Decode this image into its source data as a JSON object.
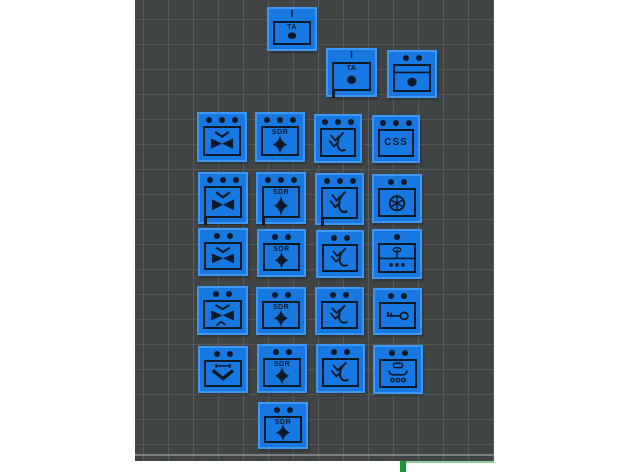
{
  "app": {
    "name": "3d-slicer-viewport",
    "description": "Build plate with 24 flat unit-marker tiles arranged for printing"
  },
  "colors": {
    "page_bg": "#ffffff",
    "plate_bg": "#404445",
    "grid_line": "#565b5c",
    "tile_fill": "#1778e2",
    "tile_outline": "#3e97f3",
    "glyph": "#0c1a28",
    "accent_green_bar": "#1a9638",
    "accent_green_line": "#8ccf98"
  },
  "viewport": {
    "x": 135,
    "y": 0,
    "width": 359,
    "height": 461,
    "grid_size_px": 25
  },
  "accents": {
    "green_bar": {
      "x": 400,
      "y": 461,
      "w": 6,
      "h": 11
    },
    "green_line": {
      "x": 406,
      "y": 461,
      "w": 88,
      "h": 2
    }
  },
  "symbols": {
    "filled-circle": "frame with TA text and solid circle",
    "band-circle": "frame with top band line and solid circle",
    "chevron-bowtie": "down chevron over solid bowtie",
    "chevron-bowtie-caret": "down chevron, solid bowtie, small caret below",
    "bar-chevron": "capped horizontal bar over bold down chevron",
    "four-point-diamond": "SDR text over solid four-point diamond",
    "double-chevron-curve": "two down-left chevrons crossed by curved stroke",
    "none": "text only frame",
    "spoked-wheel": "circle with six spokes",
    "post-ellipse-dots": "split frame, post with ellipse above, three dots below",
    "key": "horizontal key with round bow",
    "yoke-pill-dots": "pill outline, flared yoke bar, three small rings"
  },
  "tiles": [
    {
      "id": "a1",
      "symbol": "filled-circle",
      "label": "TA",
      "echelon_text": "I",
      "flag": false,
      "x": 267,
      "y": 7,
      "w": 50,
      "h": 44
    },
    {
      "id": "b1",
      "symbol": "filled-circle",
      "label": "TA",
      "echelon_text": "I",
      "flag": true,
      "x": 326,
      "y": 48,
      "w": 51,
      "h": 49
    },
    {
      "id": "b2",
      "symbol": "band-circle",
      "echelon_dots": 2,
      "x": 387,
      "y": 50,
      "w": 50,
      "h": 48
    },
    {
      "id": "c1",
      "symbol": "chevron-bowtie",
      "echelon_dots": 3,
      "x": 197,
      "y": 112,
      "w": 50,
      "h": 50
    },
    {
      "id": "c2",
      "symbol": "four-point-diamond",
      "label": "SDR",
      "echelon_dots": 3,
      "x": 255,
      "y": 112,
      "w": 50,
      "h": 50
    },
    {
      "id": "c3",
      "symbol": "double-chevron-curve",
      "echelon_dots": 3,
      "x": 314,
      "y": 114,
      "w": 48,
      "h": 49
    },
    {
      "id": "c4",
      "symbol": "none",
      "label": "CSS",
      "echelon_dots": 3,
      "x": 372,
      "y": 115,
      "w": 48,
      "h": 48
    },
    {
      "id": "d1",
      "symbol": "chevron-bowtie",
      "echelon_dots": 3,
      "flag": true,
      "x": 198,
      "y": 172,
      "w": 50,
      "h": 52
    },
    {
      "id": "d2",
      "symbol": "four-point-diamond",
      "label": "SDR",
      "echelon_dots": 3,
      "flag": true,
      "x": 256,
      "y": 172,
      "w": 50,
      "h": 52
    },
    {
      "id": "d3",
      "symbol": "double-chevron-curve",
      "echelon_dots": 3,
      "flag": true,
      "x": 315,
      "y": 173,
      "w": 49,
      "h": 52
    },
    {
      "id": "d4",
      "symbol": "spoked-wheel",
      "echelon_dots": 2,
      "x": 372,
      "y": 174,
      "w": 50,
      "h": 49
    },
    {
      "id": "e1",
      "symbol": "chevron-bowtie",
      "echelon_dots": 2,
      "x": 198,
      "y": 228,
      "w": 50,
      "h": 48
    },
    {
      "id": "e2",
      "symbol": "four-point-diamond",
      "label": "SDR",
      "echelon_dots": 2,
      "x": 257,
      "y": 229,
      "w": 49,
      "h": 48
    },
    {
      "id": "e3",
      "symbol": "double-chevron-curve",
      "echelon_dots": 2,
      "x": 316,
      "y": 230,
      "w": 48,
      "h": 48
    },
    {
      "id": "e4",
      "symbol": "post-ellipse-dots",
      "echelon_dots": 1,
      "x": 372,
      "y": 229,
      "w": 50,
      "h": 50
    },
    {
      "id": "f1",
      "symbol": "chevron-bowtie-caret",
      "echelon_dots": 2,
      "x": 197,
      "y": 286,
      "w": 51,
      "h": 49
    },
    {
      "id": "f2",
      "symbol": "four-point-diamond",
      "label": "SDR",
      "echelon_dots": 2,
      "x": 256,
      "y": 287,
      "w": 50,
      "h": 48
    },
    {
      "id": "f3",
      "symbol": "double-chevron-curve",
      "echelon_dots": 2,
      "x": 315,
      "y": 287,
      "w": 49,
      "h": 48
    },
    {
      "id": "f4",
      "symbol": "key",
      "echelon_dots": 2,
      "x": 373,
      "y": 288,
      "w": 49,
      "h": 47
    },
    {
      "id": "g1",
      "symbol": "bar-chevron",
      "echelon_dots": 2,
      "x": 198,
      "y": 346,
      "w": 50,
      "h": 47
    },
    {
      "id": "g2",
      "symbol": "four-point-diamond",
      "label": "SDR",
      "echelon_dots": 2,
      "x": 257,
      "y": 344,
      "w": 50,
      "h": 49
    },
    {
      "id": "g3",
      "symbol": "double-chevron-curve",
      "echelon_dots": 2,
      "x": 316,
      "y": 344,
      "w": 49,
      "h": 49
    },
    {
      "id": "g4",
      "symbol": "yoke-pill-dots",
      "echelon_dots": 2,
      "x": 373,
      "y": 345,
      "w": 50,
      "h": 49
    },
    {
      "id": "h1",
      "symbol": "four-point-diamond",
      "label": "SDR",
      "echelon_dots": 2,
      "x": 258,
      "y": 402,
      "w": 50,
      "h": 47
    }
  ]
}
